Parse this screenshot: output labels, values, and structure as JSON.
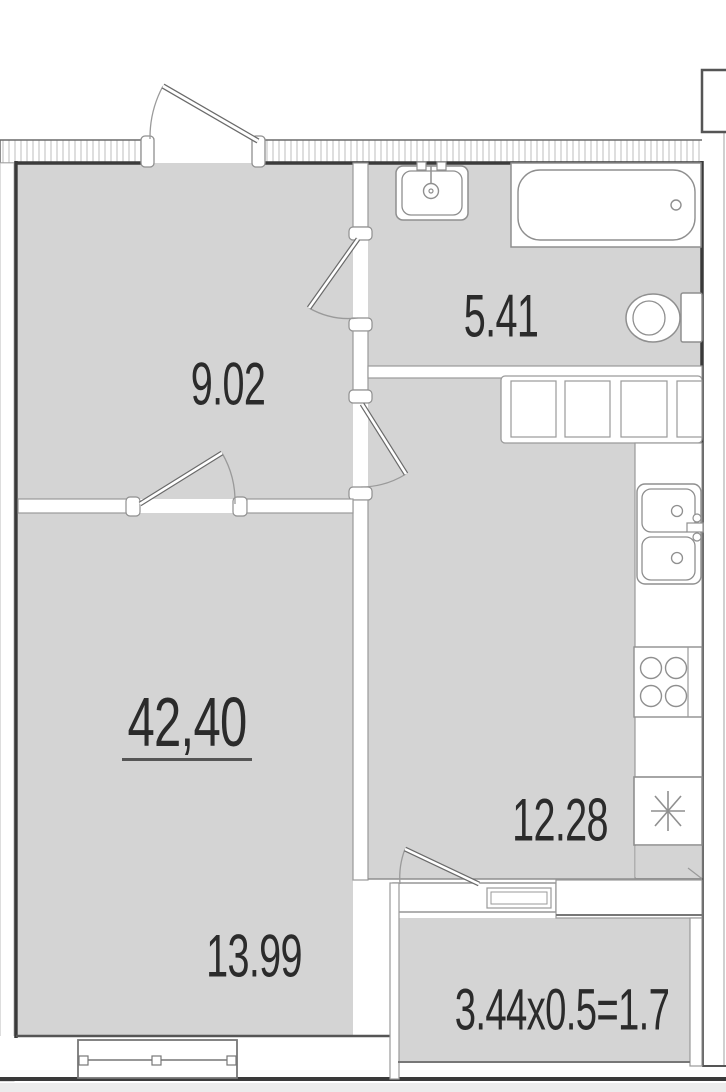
{
  "document": {
    "type": "apartment floor plan",
    "units": "square meters"
  },
  "labels": {
    "hallway_area": "9.02",
    "bathroom_area": "5.41",
    "kitchen_area": "12.28",
    "living_room_area": "13.99",
    "total_area": "42,40",
    "balcony_area_calc": "3.44x0.5=1.7"
  },
  "colors": {
    "floor": "#d4d4d4",
    "wall_dark": "#3a3a3a",
    "wall_outline": "#969696",
    "text": "#2b2b2b",
    "exterior": "#ffffff"
  },
  "fixtures": [
    "entrance-door",
    "bathroom-door",
    "kitchen-door",
    "living-room-door",
    "balcony-door",
    "bathtub",
    "washbasin",
    "toilet",
    "kitchen-cabinets",
    "kitchen-sink",
    "stove",
    "refrigerator",
    "window",
    "ventilation-shaft"
  ]
}
